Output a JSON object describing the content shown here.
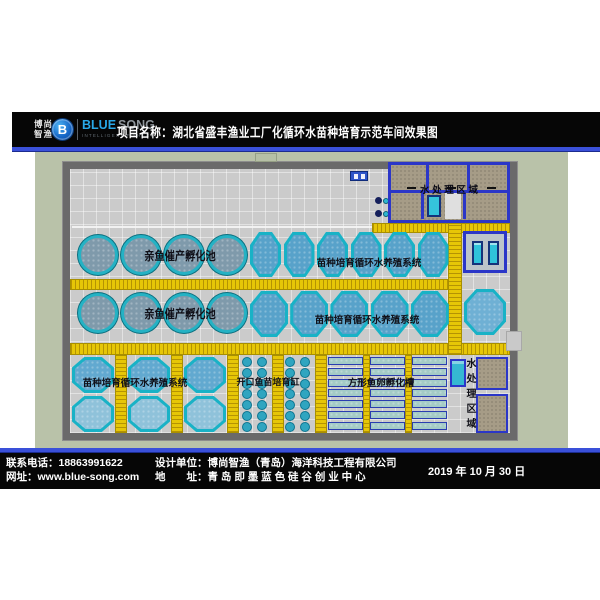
{
  "header": {
    "logo_cn_top": "博尚",
    "logo_cn_bottom": "智渔",
    "logo_badge": "B",
    "brand_primary": "BLUE",
    "brand_secondary": "SONG",
    "brand_tagline": "INTELLIGENT FISHERY",
    "project_title": "项目名称：湖北省盛丰渔业工厂化循环水苗种培育示范车间效果图"
  },
  "footer": {
    "phone": "联系电话：18863991622",
    "website": "网址：www.blue-song.com",
    "design_unit": "设计单位：博尚智渔（青岛）海洋科技工程有限公司",
    "address": "地　　址：青 岛 即 墨 蓝 色 硅 谷 创 业 中 心",
    "date": "2019 年 10 月 30 日"
  },
  "plan": {
    "water_treatment_top_label": "水 处 理 区 域",
    "water_treatment_side_label": "水处理区域",
    "row1_circle_label": "亲鱼催产孵化池",
    "row1_octagon_label": "苗种培育循环水养殖系统",
    "row2_circle_label": "亲鱼催产孵化池",
    "row2_octagon_label": "苗种培育循环水养殖系统",
    "bottom_octagon_label": "苗种培育循环水养殖系统",
    "fry_tank_label": "开口鱼苗培育缸",
    "egg_tray_label": "方形鱼卵孵化槽"
  },
  "colors": {
    "accent_line_blue": "#3a50d9",
    "walkway_yellow": "#e6c607",
    "tank_ring_cyan": "#25b2c4",
    "room_wall_blue": "#2b36c8",
    "facility_wall_gray": "#6a6a6a",
    "background_sage": "#b9c2a9"
  }
}
